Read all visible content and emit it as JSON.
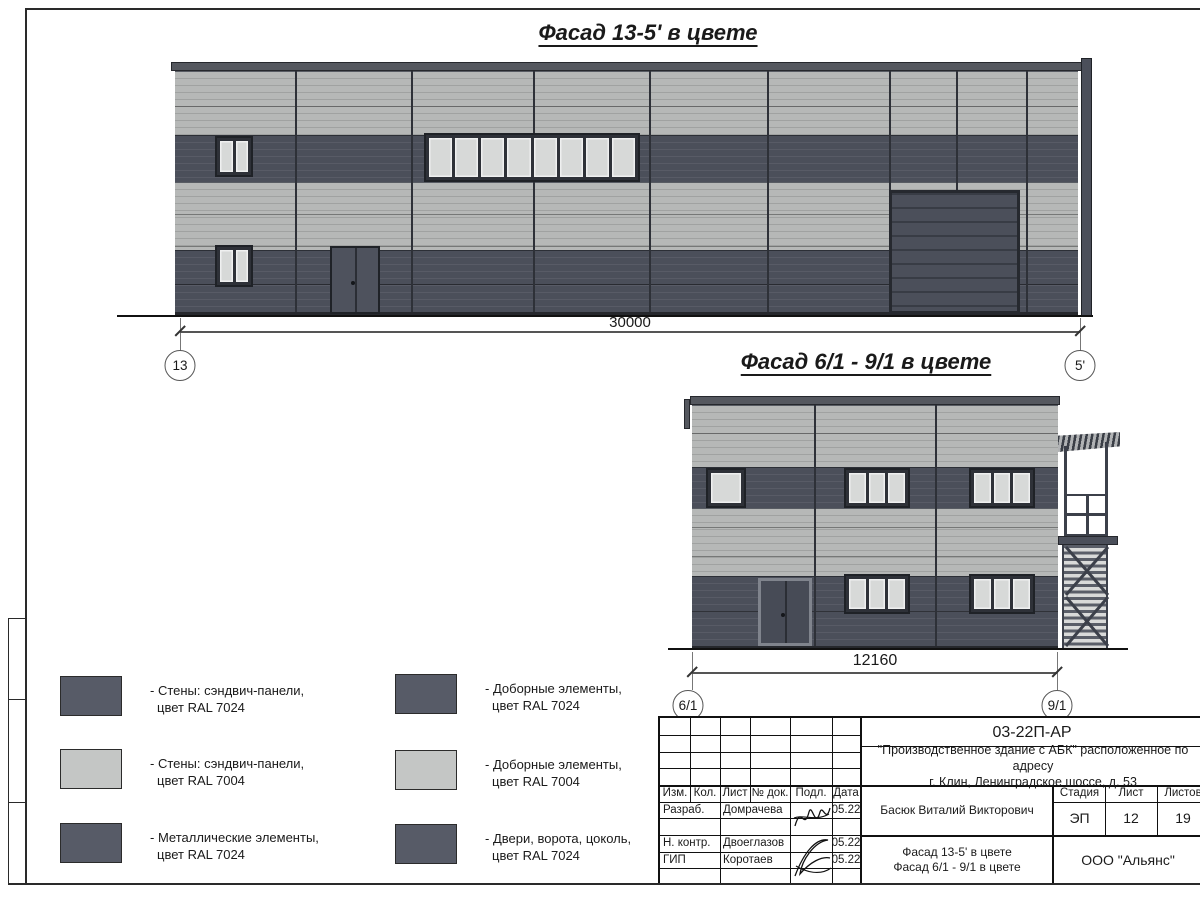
{
  "colors": {
    "panel_light": "#b6b8b7",
    "panel_dark": "#4b4f5a",
    "coping": "#55585f",
    "frame_dark": "#2e3138",
    "pane_light": "#d7d9d8",
    "swatch_dark": "#575b67",
    "swatch_light": "#c4c6c5",
    "ink": "#1a1a1a"
  },
  "facade1": {
    "title": "Фасад 13-5' в цвете",
    "dimension": "30000",
    "axis_left": "13",
    "axis_right": "5'"
  },
  "facade2": {
    "title": "Фасад 6/1 - 9/1 в цвете",
    "dimension": "12160",
    "axis_left": "6/1",
    "axis_right": "9/1"
  },
  "legend": {
    "columns": [
      {
        "items": [
          {
            "swatch": "#575b67",
            "line1": "- Стены: сэндвич-панели,",
            "line2": "цвет RAL 7024"
          },
          {
            "swatch": "#c4c6c5",
            "line1": "- Стены: сэндвич-панели,",
            "line2": "цвет RAL 7004"
          },
          {
            "swatch": "#575b67",
            "line1": "- Металлические элементы,",
            "line2": "цвет RAL 7024"
          }
        ]
      },
      {
        "items": [
          {
            "swatch": "#575b67",
            "line1": "- Доборные элементы,",
            "line2": "цвет RAL 7024"
          },
          {
            "swatch": "#c4c6c5",
            "line1": "- Доборные элементы,",
            "line2": "цвет RAL 7004"
          },
          {
            "swatch": "#575b67",
            "line1": "- Двери, ворота, цоколь,",
            "line2": "цвет RAL 7024"
          }
        ]
      }
    ]
  },
  "titleblock": {
    "doc_number": "03-22П-АР",
    "project_line1": "\"Производственное здание с АБК\" расположенное по адресу",
    "project_line2": "г. Клин, Ленинградское шоссе, д. 53",
    "columns": [
      "Изм.",
      "Кол.",
      "Лист",
      "№ док.",
      "Подл.",
      "Дата"
    ],
    "rows": [
      {
        "role": "Разраб.",
        "name": "Домрачева",
        "date": "05.22"
      },
      {
        "role": "Н. контр.",
        "name": "Двоеглазов",
        "date": "05.22"
      },
      {
        "role": "ГИП",
        "name": "Коротаев",
        "date": "05.22"
      }
    ],
    "engineer": "Басюк Виталий Викторович",
    "stage_label": "Стадия",
    "sheet_label": "Лист",
    "sheets_label": "Листов",
    "stage": "ЭП",
    "sheet_no": "12",
    "sheets_total": "19",
    "drawing_title_line1": "Фасад 13-5' в цвете",
    "drawing_title_line2": "Фасад 6/1 - 9/1 в цвете",
    "company": "ООО \"Альянс\""
  }
}
